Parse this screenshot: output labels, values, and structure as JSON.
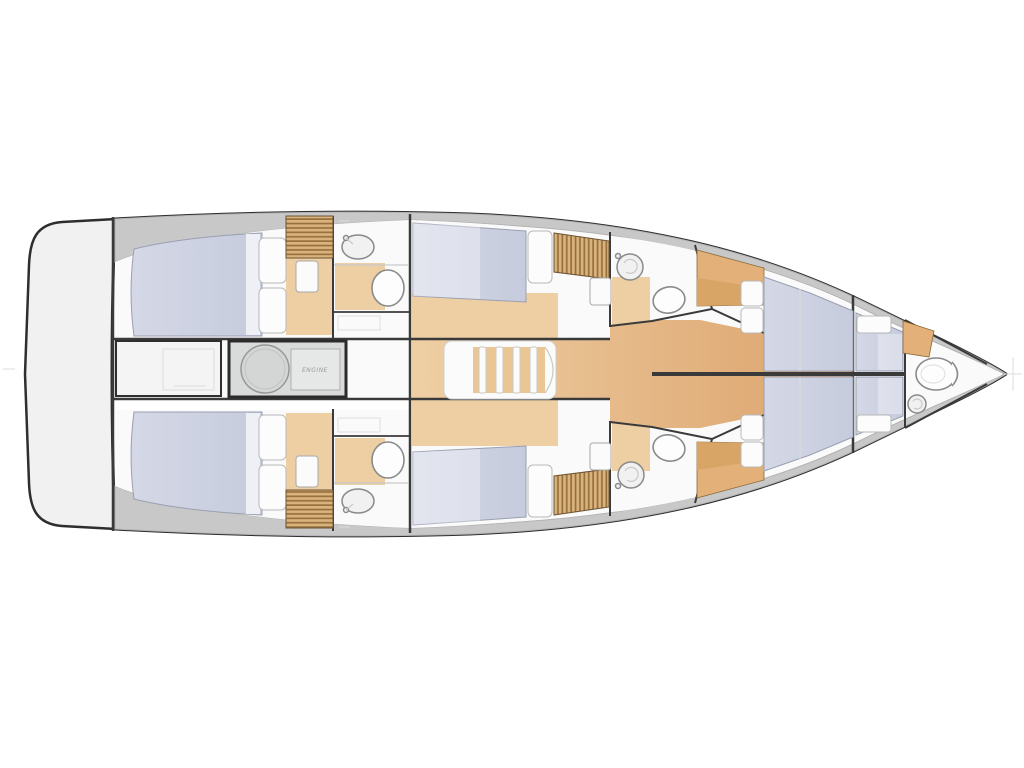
{
  "plan": {
    "engine_label": "ENGINE",
    "colors": {
      "hull-stroke": "#2e2e2e",
      "wall": "#3a3a3a",
      "deck": "#c8c8c8",
      "platform": "#f1f1f1",
      "room": "#fafafa",
      "bed-edge": "#9aa0b2",
      "pillow": "#fcfcfc",
      "wood-light": "#eecfa4",
      "wood-dark": "#dca26b",
      "slat-base": "#d9b27c",
      "slat-stripe": "#96713d",
      "cabinet": "#e2b078",
      "fixture": "#8a8a8a",
      "engine": "#d9dbda"
    }
  }
}
